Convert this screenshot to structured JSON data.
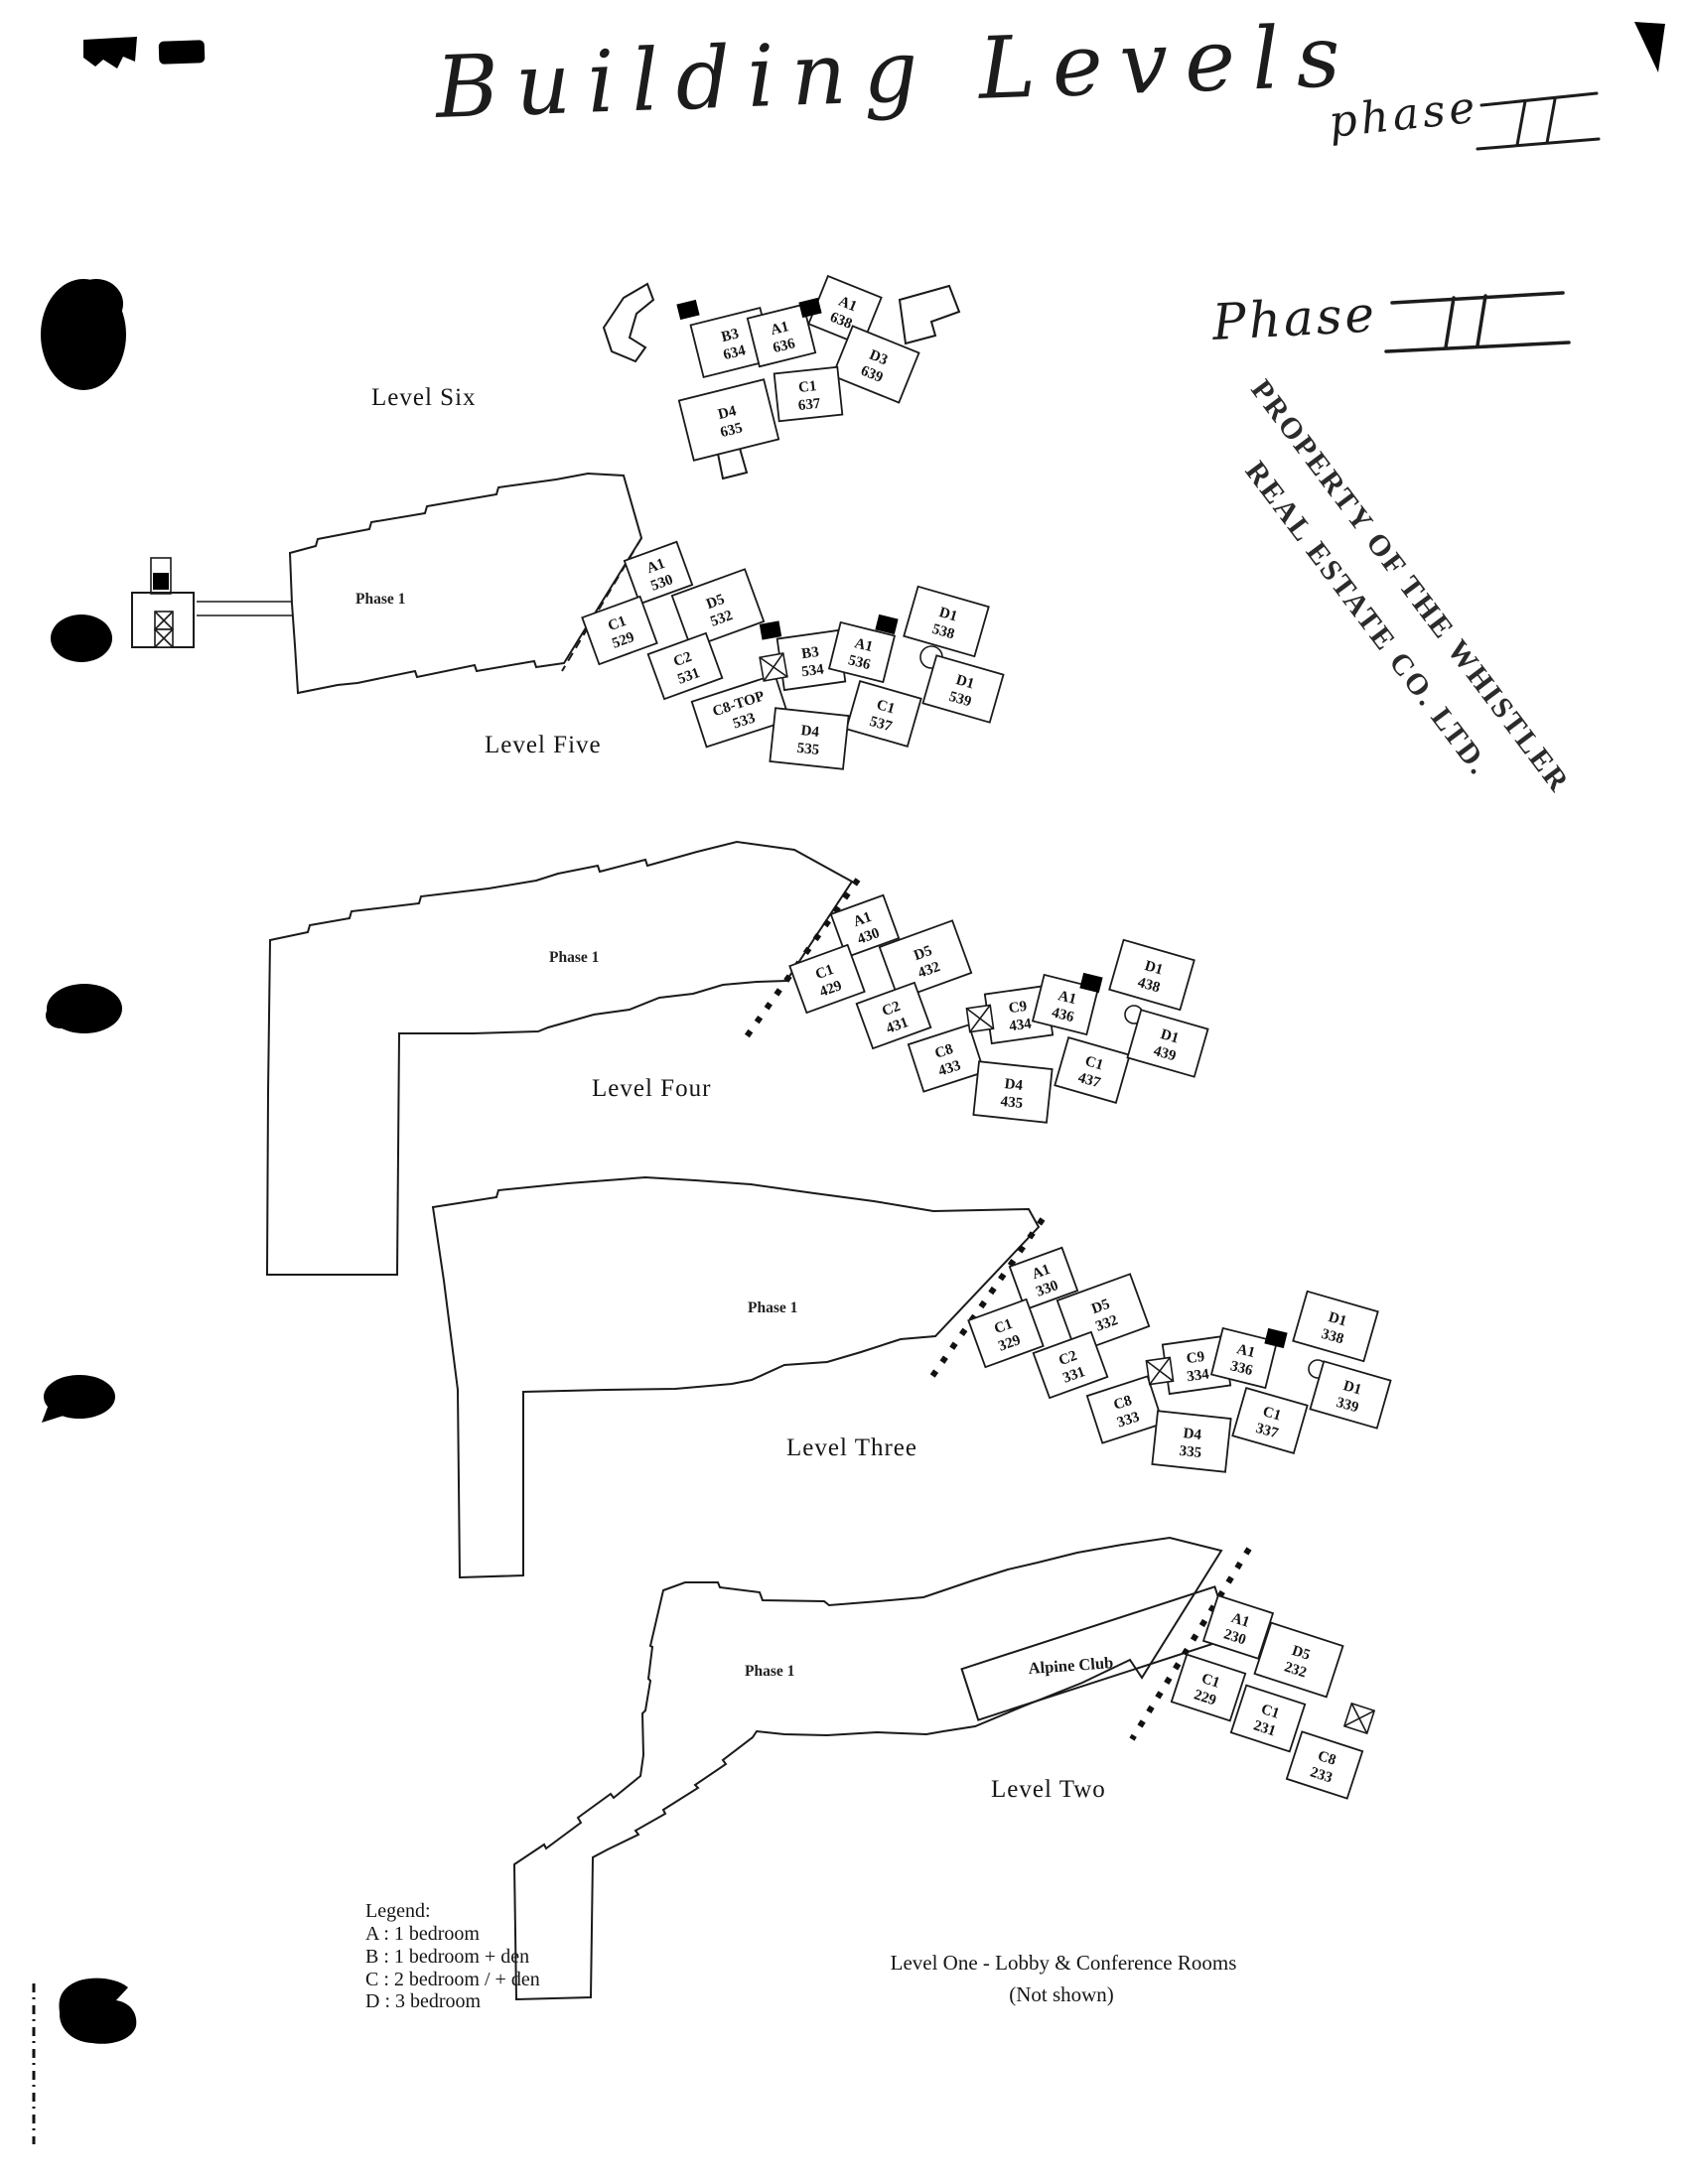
{
  "page": {
    "handwritten_title": "Building Levels",
    "handwritten_phase_top": "phase",
    "handwritten_phase_top_numeral": "II",
    "handwritten_phase_side": "Phase",
    "handwritten_phase_side_numeral": "II",
    "stamp": {
      "line1": "PROPERTY OF THE WHISTLER",
      "line2": "REAL ESTATE CO. LTD."
    },
    "footer": {
      "line1": "Level One - Lobby & Conference Rooms",
      "line2": "(Not shown)"
    }
  },
  "legend": {
    "title": "Legend:",
    "items": [
      "A : 1 bedroom",
      "B : 1 bedroom + den",
      "C : 2 bedroom / + den",
      "D : 3 bedroom"
    ]
  },
  "levels": [
    {
      "name": "Level Six",
      "units": [
        {
          "code": "B3",
          "num": "634"
        },
        {
          "code": "A1",
          "num": "636"
        },
        {
          "code": "A1",
          "num": "638"
        },
        {
          "code": "D3",
          "num": "639"
        },
        {
          "code": "C1",
          "num": "637"
        },
        {
          "code": "D4",
          "num": "635"
        }
      ]
    },
    {
      "name": "Level Five",
      "phase": "Phase 1",
      "units": [
        {
          "code": "A1",
          "num": "530"
        },
        {
          "code": "C1",
          "num": "529"
        },
        {
          "code": "D5",
          "num": "532"
        },
        {
          "code": "C2",
          "num": "531"
        },
        {
          "code": "C8-TOP",
          "num": "533"
        },
        {
          "code": "B3",
          "num": "534"
        },
        {
          "code": "A1",
          "num": "536"
        },
        {
          "code": "C1",
          "num": "537"
        },
        {
          "code": "D4",
          "num": "535"
        },
        {
          "code": "D1",
          "num": "538"
        },
        {
          "code": "D1",
          "num": "539"
        }
      ]
    },
    {
      "name": "Level Four",
      "phase": "Phase 1",
      "units": [
        {
          "code": "A1",
          "num": "430"
        },
        {
          "code": "C1",
          "num": "429"
        },
        {
          "code": "D5",
          "num": "432"
        },
        {
          "code": "C2",
          "num": "431"
        },
        {
          "code": "C8",
          "num": "433"
        },
        {
          "code": "C9",
          "num": "434"
        },
        {
          "code": "A1",
          "num": "436"
        },
        {
          "code": "C1",
          "num": "437"
        },
        {
          "code": "D4",
          "num": "435"
        },
        {
          "code": "D1",
          "num": "438"
        },
        {
          "code": "D1",
          "num": "439"
        }
      ]
    },
    {
      "name": "Level Three",
      "phase": "Phase 1",
      "units": [
        {
          "code": "A1",
          "num": "330"
        },
        {
          "code": "C1",
          "num": "329"
        },
        {
          "code": "D5",
          "num": "332"
        },
        {
          "code": "C2",
          "num": "331"
        },
        {
          "code": "C8",
          "num": "333"
        },
        {
          "code": "C9",
          "num": "334"
        },
        {
          "code": "A1",
          "num": "336"
        },
        {
          "code": "C1",
          "num": "337"
        },
        {
          "code": "D4",
          "num": "335"
        },
        {
          "code": "D1",
          "num": "338"
        },
        {
          "code": "D1",
          "num": "339"
        }
      ]
    },
    {
      "name": "Level Two",
      "phase": "Phase 1",
      "alpine_club": "Alpine Club",
      "units": [
        {
          "code": "A1",
          "num": "230"
        },
        {
          "code": "C1",
          "num": "229"
        },
        {
          "code": "D5",
          "num": "232"
        },
        {
          "code": "C1",
          "num": "231"
        },
        {
          "code": "C8",
          "num": "233"
        }
      ]
    }
  ]
}
